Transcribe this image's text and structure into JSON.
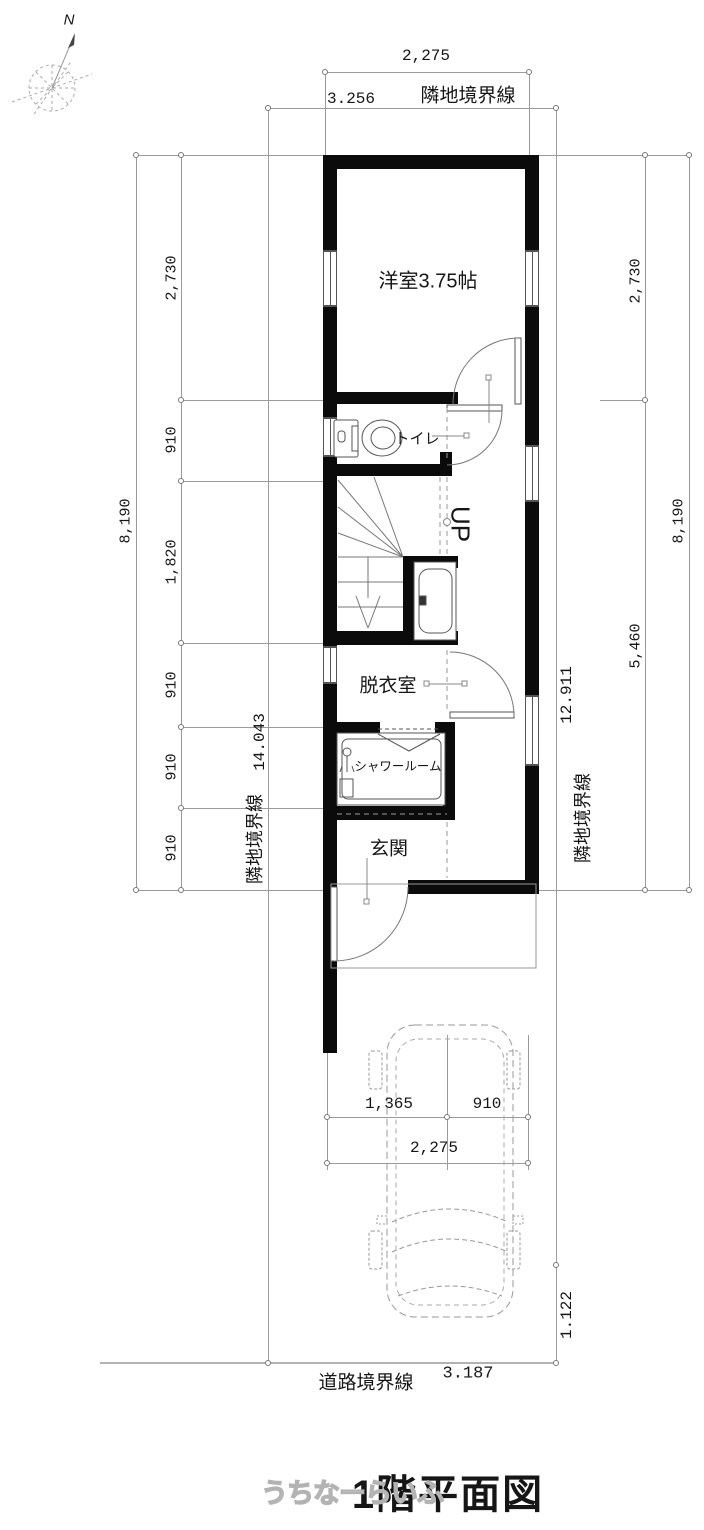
{
  "labels": {
    "title": "1階平面図",
    "watermark": "うちなーらいふ",
    "north": "N",
    "room_main": "洋室3.75帖",
    "toilet": "トイレ",
    "up": "UP",
    "dressing": "脱衣室",
    "shower": "シャワールーム",
    "entrance": "玄関",
    "boundary_side": "隣地境界線",
    "boundary_road": "道路境界線"
  },
  "dims": {
    "top_width": "2,275",
    "top_boundary": "3.256",
    "left_outer": "8,190",
    "left_chain": [
      "2,730",
      "910",
      "1,820",
      "910",
      "910",
      "910"
    ],
    "left_boundary": "14.043",
    "right_chain": [
      "2,730",
      "5,460"
    ],
    "right_outer": "8,190",
    "right_boundary": "12.911",
    "bottom_chain": [
      "1,365",
      "910"
    ],
    "bottom_width": "2,275",
    "road_boundary": "3.187",
    "setback": "1.122"
  }
}
